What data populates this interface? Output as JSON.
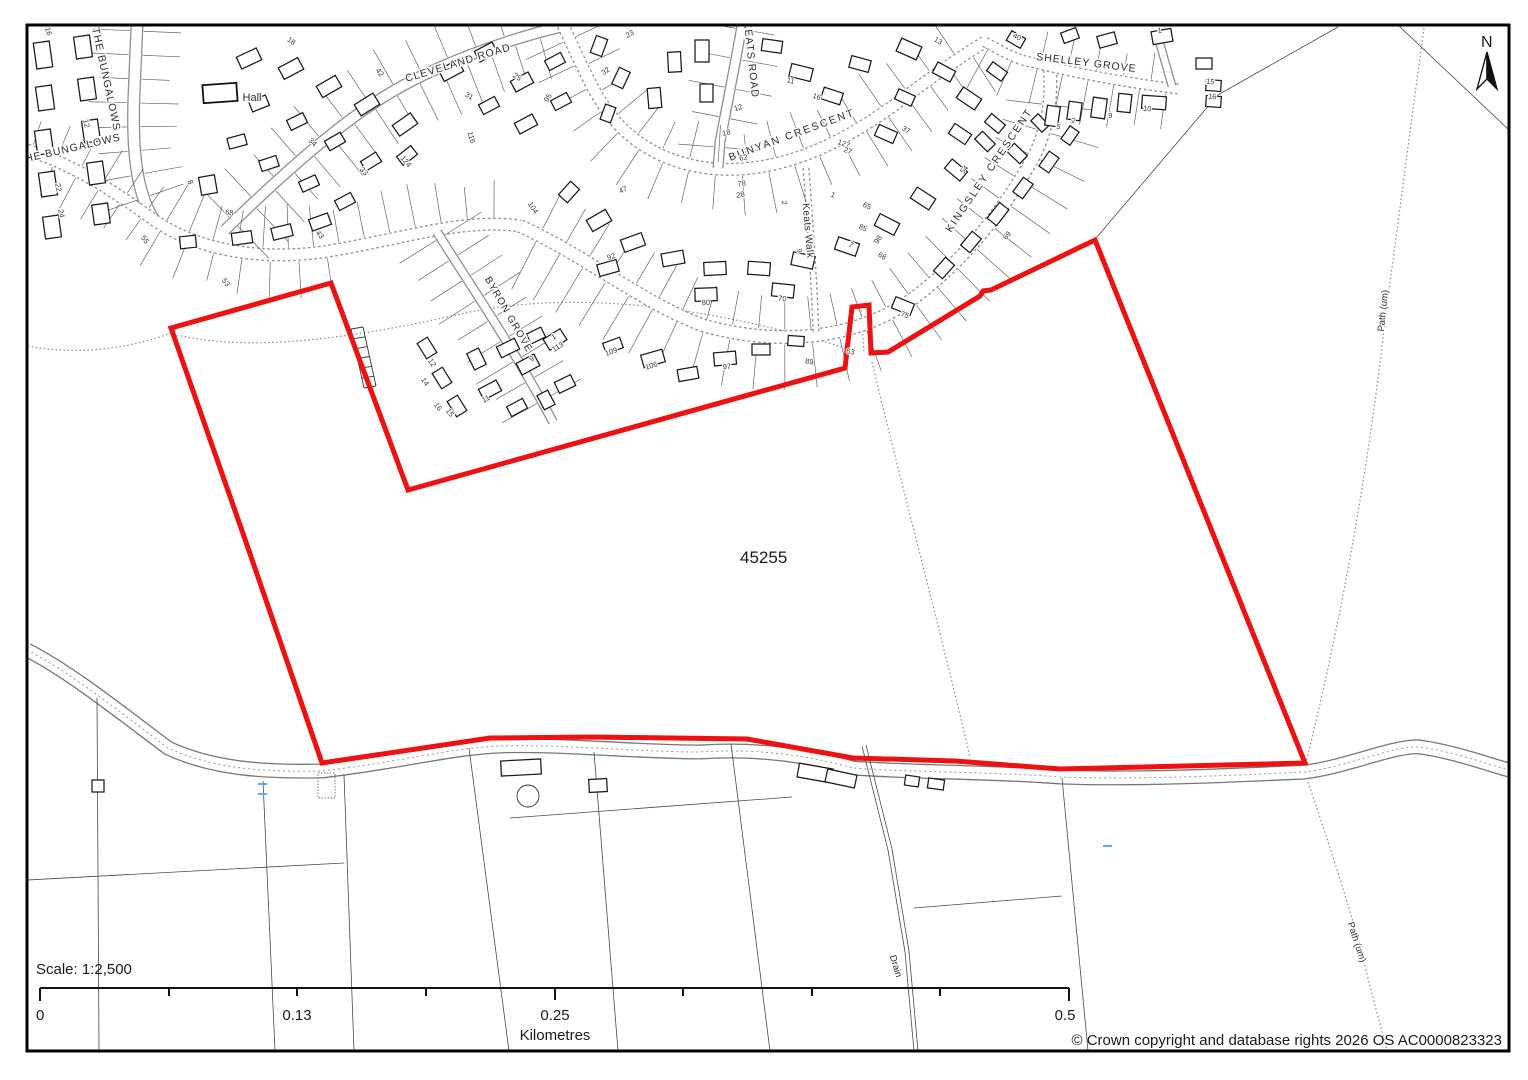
{
  "map": {
    "site_ref_label": "45255",
    "boundary_color": "#ee1111",
    "north_label": "N",
    "street_labels": [
      {
        "text": "THE BUNGALOWS",
        "x": 103,
        "y": 80,
        "rotate": 78,
        "size": 10.5,
        "spacing": 1
      },
      {
        "text": "THE BUNGALOWS",
        "x": 70,
        "y": 152,
        "rotate": -13,
        "size": 10.5,
        "spacing": 1
      },
      {
        "text": "CLEVELAND ROAD",
        "x": 459,
        "y": 66,
        "rotate": -17,
        "size": 10.5,
        "spacing": 1
      },
      {
        "text": "KEATS ROAD",
        "x": 748,
        "y": 60,
        "rotate": 84,
        "size": 10.5,
        "spacing": 1
      },
      {
        "text": "BUNYAN  CRESCENT",
        "x": 793,
        "y": 138,
        "rotate": -20,
        "size": 10.5,
        "spacing": 2
      },
      {
        "text": "KINGSLEY  CRESCENT",
        "x": 992,
        "y": 172,
        "rotate": -56,
        "size": 10.5,
        "spacing": 2
      },
      {
        "text": "SHELLEY GROVE",
        "x": 1086,
        "y": 66,
        "rotate": 7,
        "size": 10.5,
        "spacing": 1
      },
      {
        "text": "BYRON GROVE",
        "x": 506,
        "y": 316,
        "rotate": 60,
        "size": 10,
        "spacing": 1
      },
      {
        "text": "Keats Walk",
        "x": 805,
        "y": 231,
        "rotate": 85,
        "size": 10,
        "spacing": 0.5
      },
      {
        "text": "Hall",
        "x": 252,
        "y": 101,
        "rotate": 0,
        "size": 11,
        "spacing": 0
      },
      {
        "text": "Path (um)",
        "x": 1386,
        "y": 311,
        "rotate": -84,
        "size": 9.5,
        "spacing": 0
      },
      {
        "text": "Path (um)",
        "x": 1354,
        "y": 943,
        "rotate": 72,
        "size": 9.5,
        "spacing": 0
      },
      {
        "text": "Drain",
        "x": 893,
        "y": 967,
        "rotate": 73,
        "size": 9.5,
        "spacing": 0
      }
    ],
    "house_numbers": [
      {
        "t": "16",
        "x": 46,
        "y": 32,
        "r": 75
      },
      {
        "t": "18",
        "x": 290,
        "y": 43,
        "r": 35
      },
      {
        "t": "12",
        "x": 84,
        "y": 124,
        "r": 78
      },
      {
        "t": "22",
        "x": 56,
        "y": 188,
        "r": 78
      },
      {
        "t": "24",
        "x": 59,
        "y": 214,
        "r": 78
      },
      {
        "t": "8",
        "x": 188,
        "y": 183,
        "r": 70
      },
      {
        "t": "68",
        "x": 229,
        "y": 215,
        "r": 8
      },
      {
        "t": "53",
        "x": 224,
        "y": 284,
        "r": 50
      },
      {
        "t": "55",
        "x": 143,
        "y": 241,
        "r": 55
      },
      {
        "t": "42",
        "x": 378,
        "y": 74,
        "r": 48
      },
      {
        "t": "34",
        "x": 311,
        "y": 144,
        "r": 45
      },
      {
        "t": "33",
        "x": 362,
        "y": 173,
        "r": 48
      },
      {
        "t": "124",
        "x": 404,
        "y": 163,
        "r": 50
      },
      {
        "t": "43",
        "x": 318,
        "y": 236,
        "r": 52
      },
      {
        "t": "25",
        "x": 516,
        "y": 79,
        "r": 32
      },
      {
        "t": "31",
        "x": 468,
        "y": 98,
        "r": 28
      },
      {
        "t": "116",
        "x": 469,
        "y": 138,
        "r": 75
      },
      {
        "t": "104",
        "x": 531,
        "y": 209,
        "r": 58
      },
      {
        "t": "92",
        "x": 612,
        "y": 259,
        "r": -18
      },
      {
        "t": "23",
        "x": 631,
        "y": 36,
        "r": -30
      },
      {
        "t": "32",
        "x": 607,
        "y": 73,
        "r": -35
      },
      {
        "t": "18",
        "x": 727,
        "y": 135,
        "r": -15
      },
      {
        "t": "12",
        "x": 739,
        "y": 110,
        "r": -18
      },
      {
        "t": "11",
        "x": 790,
        "y": 83,
        "r": 15
      },
      {
        "t": "16",
        "x": 816,
        "y": 99,
        "r": 18
      },
      {
        "t": "127",
        "x": 843,
        "y": 146,
        "r": 20
      },
      {
        "t": "78",
        "x": 742,
        "y": 186,
        "r": -10
      },
      {
        "t": "2",
        "x": 782,
        "y": 203,
        "r": 80
      },
      {
        "t": "9",
        "x": 797,
        "y": 251,
        "r": 80
      },
      {
        "t": "13",
        "x": 937,
        "y": 43,
        "r": 30
      },
      {
        "t": "40",
        "x": 1016,
        "y": 39,
        "r": 25
      },
      {
        "t": "27",
        "x": 847,
        "y": 153,
        "r": 20
      },
      {
        "t": "54",
        "x": 966,
        "y": 171,
        "r": -50
      },
      {
        "t": "1",
        "x": 832,
        "y": 197,
        "r": 25
      },
      {
        "t": "7",
        "x": 850,
        "y": 247,
        "r": 28
      },
      {
        "t": "68",
        "x": 881,
        "y": 258,
        "r": 30
      },
      {
        "t": "69",
        "x": 1009,
        "y": 237,
        "r": -52
      },
      {
        "t": "28",
        "x": 741,
        "y": 197,
        "r": -12
      },
      {
        "t": "47",
        "x": 624,
        "y": 192,
        "r": -25
      },
      {
        "t": "80",
        "x": 706,
        "y": 305,
        "r": -3
      },
      {
        "t": "70",
        "x": 782,
        "y": 301,
        "r": 7
      },
      {
        "t": "95",
        "x": 550,
        "y": 99,
        "r": -60
      },
      {
        "t": "113",
        "x": 559,
        "y": 349,
        "r": -30
      },
      {
        "t": "97",
        "x": 727,
        "y": 369,
        "r": -4
      },
      {
        "t": "89",
        "x": 809,
        "y": 364,
        "r": 8
      },
      {
        "t": "63",
        "x": 850,
        "y": 354,
        "r": 12
      },
      {
        "t": "75",
        "x": 904,
        "y": 317,
        "r": 20
      },
      {
        "t": "15",
        "x": 1210,
        "y": 84,
        "r": 5
      },
      {
        "t": "16",
        "x": 1212,
        "y": 99,
        "r": 5
      },
      {
        "t": "10",
        "x": 1147,
        "y": 111,
        "r": 5
      },
      {
        "t": "9",
        "x": 1110,
        "y": 118,
        "r": 8
      },
      {
        "t": "2",
        "x": 1073,
        "y": 123,
        "r": 10
      },
      {
        "t": "5",
        "x": 1058,
        "y": 129,
        "r": 10
      },
      {
        "t": "1",
        "x": 1160,
        "y": 33,
        "r": -8
      },
      {
        "t": "98",
        "x": 880,
        "y": 241,
        "r": -55
      },
      {
        "t": "12",
        "x": 430,
        "y": 364,
        "r": 58
      },
      {
        "t": "14",
        "x": 423,
        "y": 383,
        "r": 58
      },
      {
        "t": "16",
        "x": 436,
        "y": 408,
        "r": 55
      },
      {
        "t": "15",
        "x": 448,
        "y": 414,
        "r": 55
      },
      {
        "t": "9",
        "x": 533,
        "y": 361,
        "r": -28
      },
      {
        "t": "1",
        "x": 555,
        "y": 339,
        "r": -30
      },
      {
        "t": "11",
        "x": 487,
        "y": 401,
        "r": -28
      },
      {
        "t": "109",
        "x": 612,
        "y": 354,
        "r": -20
      },
      {
        "t": "106",
        "x": 652,
        "y": 368,
        "r": -16
      },
      {
        "t": "37",
        "x": 905,
        "y": 132,
        "r": 28
      },
      {
        "t": "62",
        "x": 744,
        "y": 160,
        "r": -12
      },
      {
        "t": "65",
        "x": 866,
        "y": 208,
        "r": 25
      },
      {
        "t": "85",
        "x": 862,
        "y": 230,
        "r": 25
      }
    ]
  },
  "scale_bar": {
    "label": "Scale: 1:2,500",
    "tick_labels": [
      "0",
      "0.13",
      "0.25",
      "0.5"
    ],
    "unit": "Kilometres"
  },
  "footer": {
    "copyright": "© Crown copyright and database rights 2026 OS AC0000823323"
  }
}
